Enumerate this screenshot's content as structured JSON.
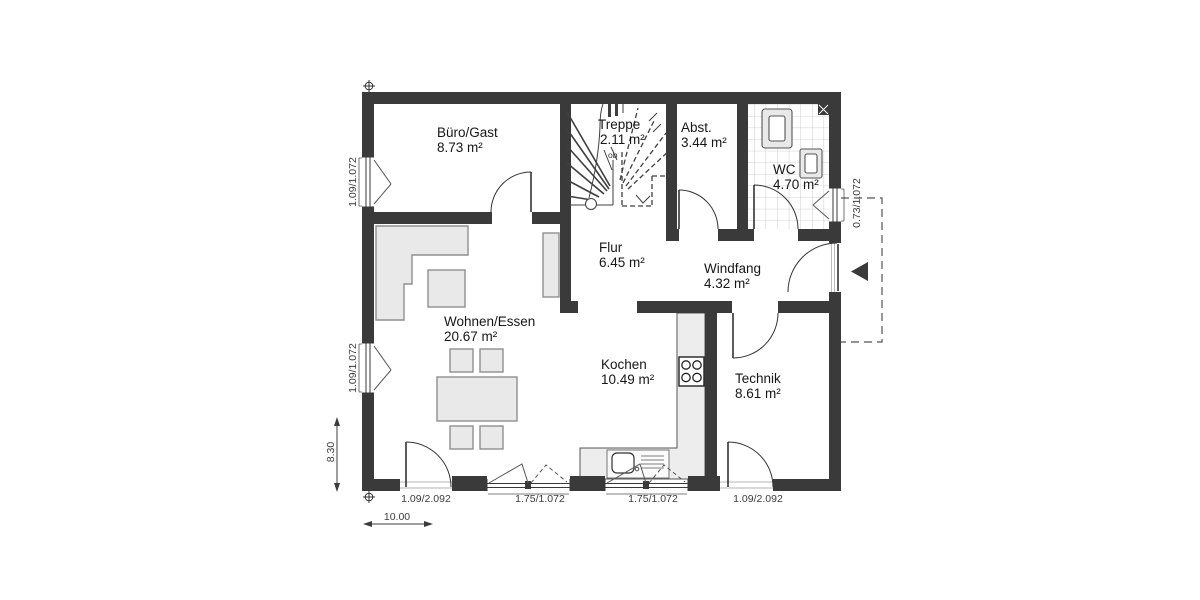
{
  "plan": {
    "rooms": {
      "buero": {
        "name": "Büro/Gast",
        "area": "8.73 m²"
      },
      "treppe": {
        "name": "Treppe",
        "area": "2.11 m²"
      },
      "abst": {
        "name": "Abst.",
        "area": "3.44 m²"
      },
      "wc": {
        "name": "WC",
        "area": "4.70 m²"
      },
      "flur": {
        "name": "Flur",
        "area": "6.45 m²"
      },
      "windfang": {
        "name": "Windfang",
        "area": "4.32 m²"
      },
      "wohnen": {
        "name": "Wohnen/Essen",
        "area": "20.67 m²"
      },
      "kochen": {
        "name": "Kochen",
        "area": "10.49 m²"
      },
      "technik": {
        "name": "Technik",
        "area": "8.61 m²"
      }
    },
    "stair_note": "ob",
    "dimensions": {
      "left_windows": [
        "1.09/1.072",
        "1.09/1.072"
      ],
      "left_height": "8.30",
      "right_window": "0.73/1.072",
      "bottom_openings": [
        "1.09/2.092",
        "1.75/1.072",
        "1.75/1.072",
        "1.09/2.092"
      ],
      "width_scale": "10.00"
    },
    "colors": {
      "wall": "#3a3a3a",
      "furniture_fill": "#e9e9e9",
      "counter_fill": "#ededed",
      "tile_line": "#c2c2c2",
      "dim_text": "#3c3c3c"
    }
  }
}
